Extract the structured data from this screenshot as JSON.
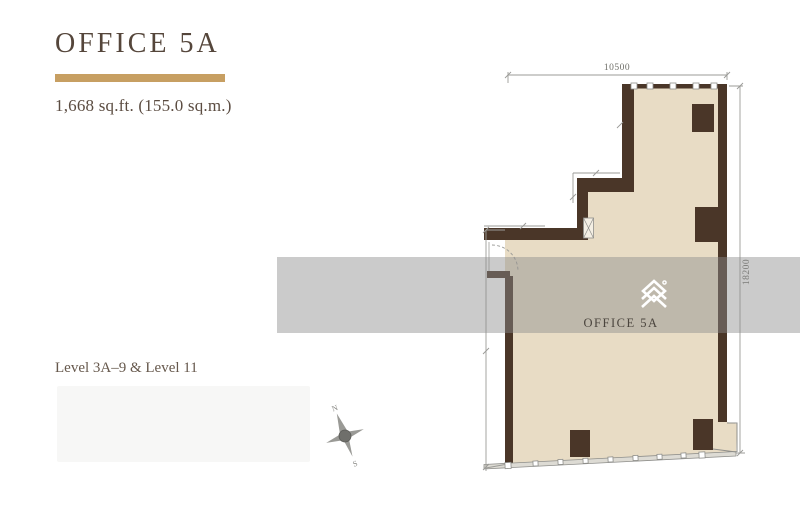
{
  "header": {
    "title": "OFFICE 5A",
    "area": "1,668 sq.ft. (155.0 sq.m.)",
    "levels": "Level 3A–9 & Level 11"
  },
  "plan": {
    "unit_label": "OFFICE 5A",
    "width_dim": "10500",
    "height_dim": "18200",
    "logo_icon": "stacked-chevron-building-logo"
  },
  "compass": {
    "north_label": "N",
    "south_label": "S"
  },
  "colors": {
    "accent_gold": "#c79f62",
    "wall_brown": "#4a3628",
    "floor_beige": "#e8dcc5",
    "title_brown": "#55463b",
    "dim_gray": "#8f8f8b",
    "watermark_band": "#8c8c8c"
  }
}
